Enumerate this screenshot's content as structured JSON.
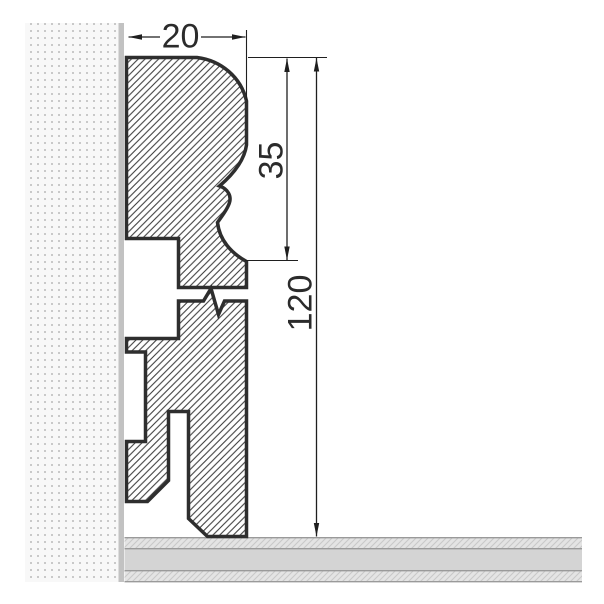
{
  "diagram": {
    "title": "Skirting board profile cross-section with wall and floor",
    "dimensions": {
      "width": {
        "label": "20",
        "value": 20
      },
      "upper_height": {
        "label": "35",
        "value": 35
      },
      "total_height": {
        "label": "120",
        "value": 120
      }
    },
    "elements": {
      "wall": "stippled wall section (left)",
      "floor": "layered floor section (bottom)",
      "profile_upper_section": "hatched moulded top of skirting profile",
      "profile_lower_section": "hatched lower body of skirting profile with cable grooves, shown with break symbol"
    },
    "colors": {
      "background": "#ffffff",
      "outline": "#2e2e2e",
      "hatch": "#3d3d3d",
      "dim_line": "#1f1f1f",
      "dim_text": "#2b2b2b",
      "wall_bg": "#f8f8f8",
      "wall_dot": "#c9c9c9",
      "wall_edge": "#c2c2c2",
      "floor_band": "#e4e4e4",
      "floor_hatch": "#c8c8c8",
      "floor_mid": "#d4d4d4",
      "floor_line": "#9a9a9a"
    }
  }
}
